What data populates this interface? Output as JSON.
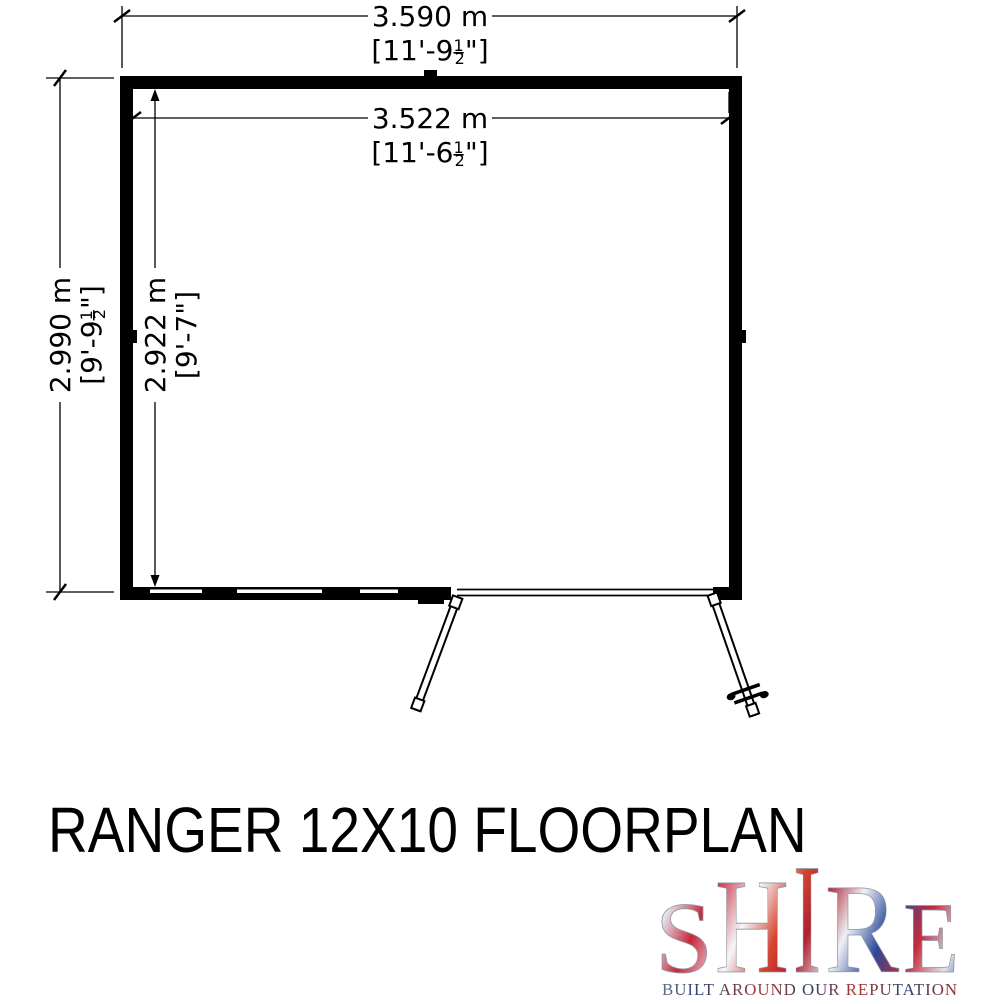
{
  "title": "RANGER 12X10 FLOORPLAN",
  "floorplan": {
    "dims": {
      "outer_width": {
        "metric": "3.590 m",
        "imp_pre": "[11'-9",
        "imp_num": "1",
        "imp_den": "2",
        "imp_post": "\"]"
      },
      "inner_width": {
        "metric": "3.522 m",
        "imp_pre": "[11'-6",
        "imp_num": "1",
        "imp_den": "2",
        "imp_post": "\"]"
      },
      "outer_depth": {
        "metric": "2.990 m",
        "imp_pre": "[9'-9",
        "imp_num": "1",
        "imp_den": "2",
        "imp_post": "\"]"
      },
      "inner_depth": {
        "metric": "2.922 m",
        "imperial": "[9'-7\"]"
      }
    }
  },
  "logo": {
    "letters": [
      "S",
      "H",
      "I",
      "R",
      "E"
    ],
    "tagline": "BUILT AROUND OUR REPUTATION",
    "flag_red": "#c8102e",
    "flag_blue": "#1d3c8f",
    "flag_silver": "#e9eef3",
    "tagline_navy": "#2c4070",
    "tagline_red": "#a93226"
  }
}
